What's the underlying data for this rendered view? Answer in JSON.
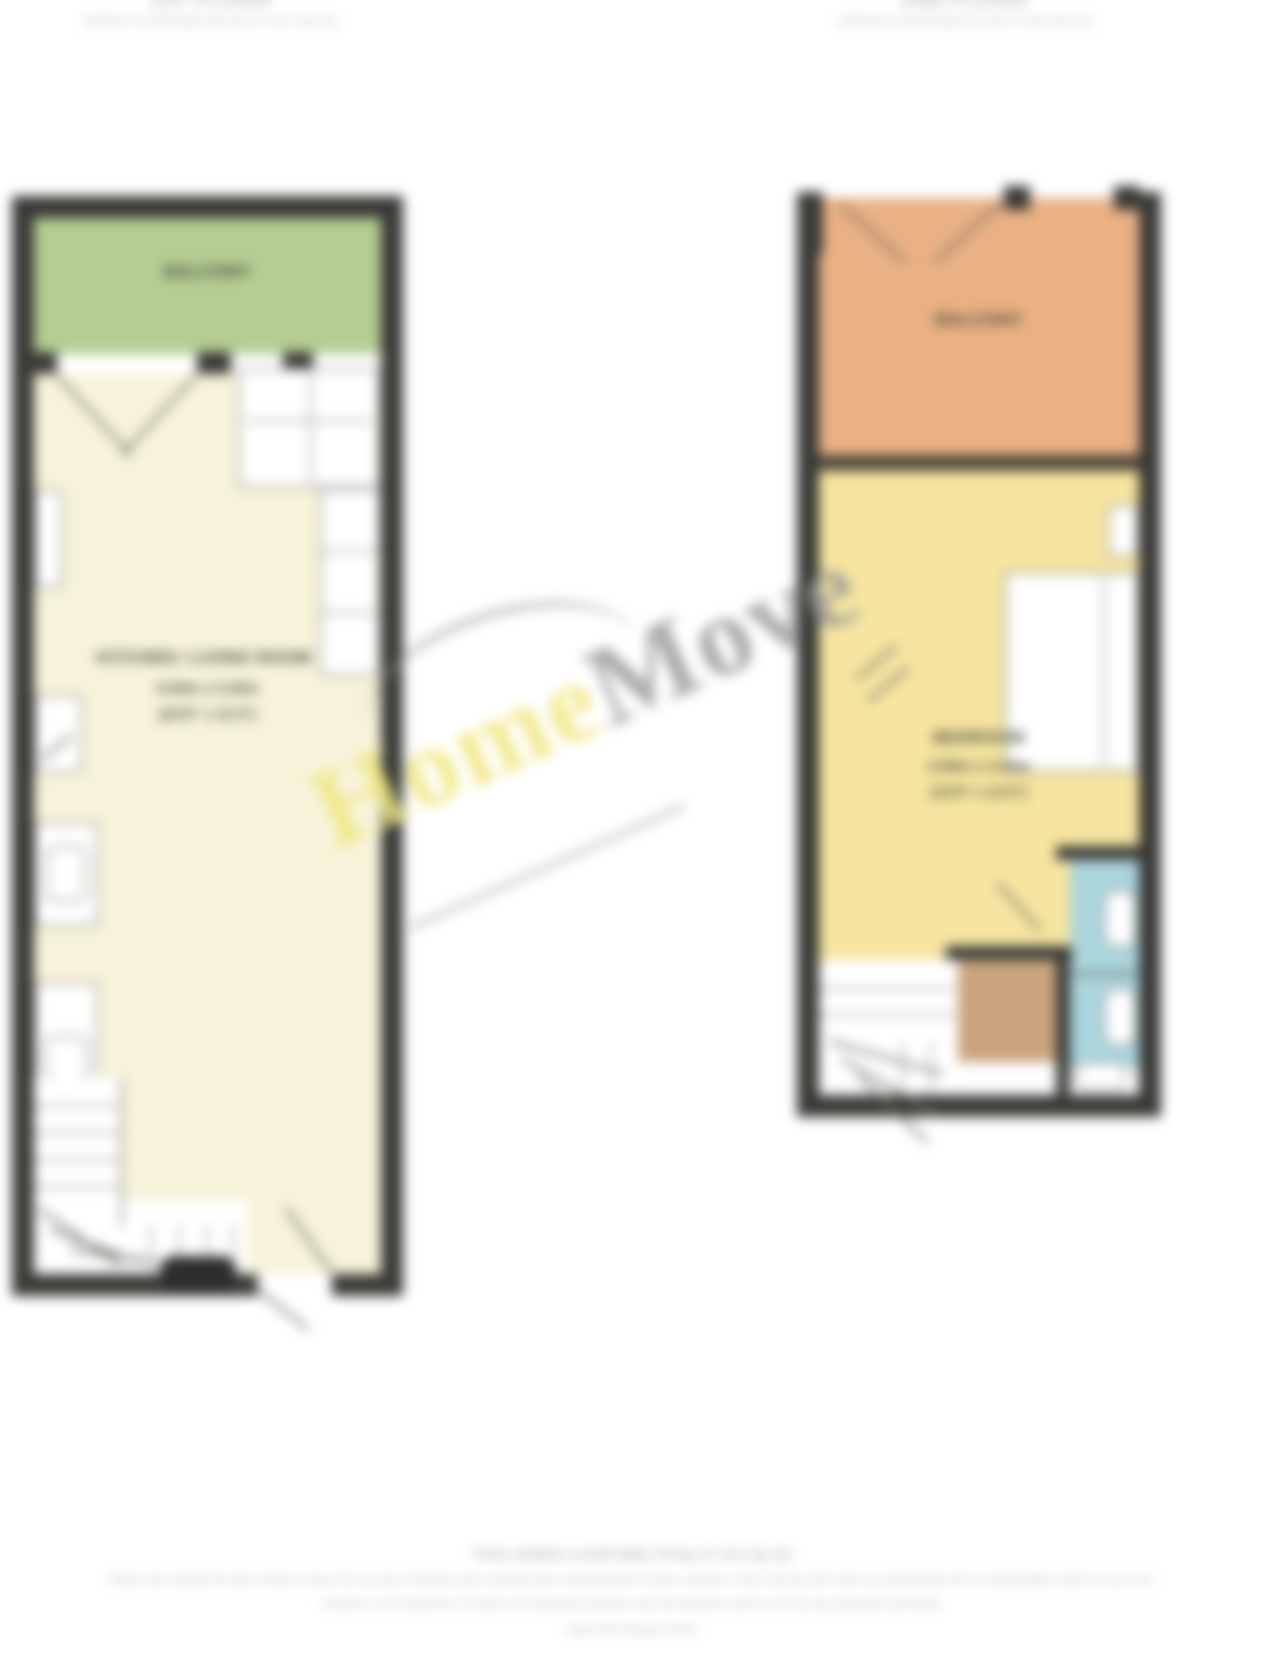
{
  "colors": {
    "wall": "#3a3a37",
    "balcony_green": "#b5cd92",
    "living_cream": "#f7f3da",
    "terrace_orange": "#e9b184",
    "bedroom_yellow": "#f5e5a0",
    "bathroom_blue": "#abd5dc",
    "cupboard_tan": "#c9a47d"
  },
  "watermark": {
    "home": "Home",
    "move": "Move"
  },
  "floors": {
    "first": {
      "title": "1ST FLOOR",
      "area": "APPROX. FLOOR AREA 507 SQ. FT. (47.1 SQ. M.)",
      "balcony_label": "BALCONY",
      "room_name": "KITCHEN / LIVING ROOM",
      "dims_metric": "6.93m x 3.43m",
      "dims_imperial": "(22'9\" x 11'3\")"
    },
    "second": {
      "title": "2ND FLOOR",
      "area": "APPROX. FLOOR AREA 271 SQ. FT. (25.2 SQ. M.)",
      "balcony_label": "BALCONY",
      "room_name": "BEDROOM",
      "dims_metric": "4.06m x 3.40m",
      "dims_imperial": "(13'4\" x 11'2\")"
    }
  },
  "footer": {
    "lines": [
      "TOTAL APPROX. FLOOR AREA 778 SQ. FT. (72.3 SQ. M.)",
      "Whilst every attempt has been made to ensure the accuracy of the floor plan contained here, measurements of doors, windows, rooms and any other items are approximate and no responsibility is taken for any error,",
      "omission, or mis-statement. This plan is for illustrative purposes only and should be used as such by any prospective purchaser.",
      "Made with Metropix ©2024"
    ]
  }
}
